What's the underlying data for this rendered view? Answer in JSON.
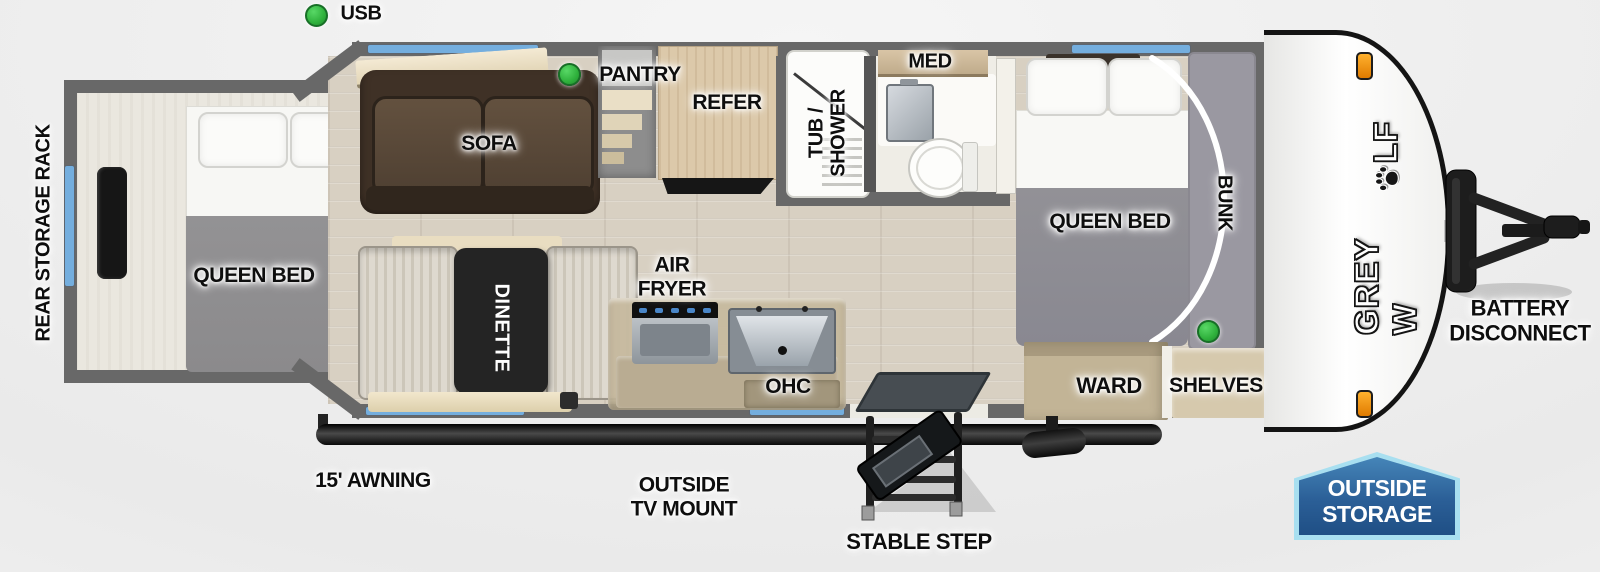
{
  "diagram_type": "rv-travel-trailer-floorplan",
  "brand": {
    "name_full": "GREY WOLF",
    "name_prefix": "GREY W",
    "name_suffix": "LF",
    "paw_icon_replaces_letter": "O"
  },
  "labels": {
    "usb": "USB",
    "rear_storage_rack": "REAR STORAGE RACK",
    "rear_queen_bed": "QUEEN BED",
    "sofa": "SOFA",
    "pantry": "PANTRY",
    "refer": "REFER",
    "dinette": "DINETTE",
    "air_fryer_line1": "AIR",
    "air_fryer_line2": "FRYER",
    "ohc": "OHC",
    "tub_shower_line1": "TUB /",
    "tub_shower_line2": "SHOWER",
    "med": "MED",
    "front_queen_bed": "QUEEN BED",
    "bunk": "BUNK",
    "ward": "WARD",
    "shelves": "SHELVES",
    "awning": "15' AWNING",
    "outside_tv_line1": "OUTSIDE",
    "outside_tv_line2": "TV MOUNT",
    "stable_step": "STABLE STEP",
    "battery_line1": "BATTERY",
    "battery_line2": "DISCONNECT",
    "outside_storage_line1": "OUTSIDE",
    "outside_storage_line2": "STORAGE"
  },
  "indicators": {
    "usb_dot": "green",
    "pantry_dot": "green",
    "bunk_dot": "green",
    "count": 3
  },
  "colors": {
    "wall_gray": "#686868",
    "window_blue": "#74aede",
    "indicator_green": "#2fb13c",
    "marker_orange": "#f59a23",
    "badge_border_blue": "#a8dff0",
    "badge_fill_blue": "#2b5f97",
    "sofa_brown": "#5a4837",
    "wood_floor": "#d8d0c2",
    "table_black": "#242424"
  }
}
